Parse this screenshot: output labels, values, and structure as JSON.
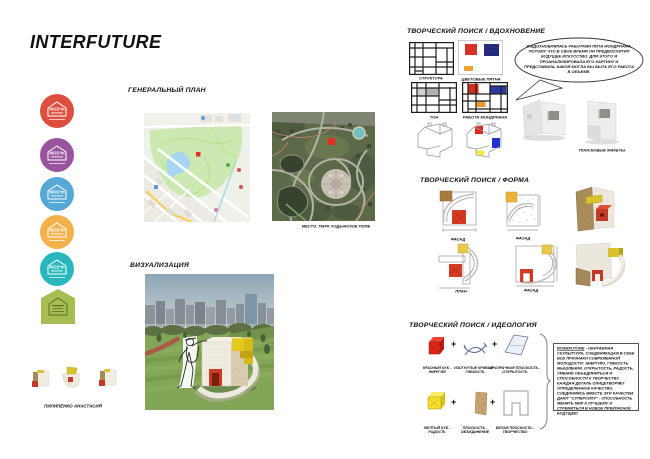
{
  "poster": {
    "title": "INTERFUTURE",
    "author": "ПИЛИПЕНКО АНАСТАСИЯ"
  },
  "badges": {
    "logo": "MOD'in",
    "colors": [
      "#dc4f3e",
      "#99549f",
      "#56a8d6",
      "#f3b14c",
      "#27b7bd",
      "#a5bd51"
    ]
  },
  "genplan": {
    "title": "ГЕНЕРАЛЬНЫЙ ПЛАН",
    "caption": "МЕСТО: ПАРК ХОДЫНСКОЕ ПОЛЕ"
  },
  "visualization": {
    "title": "ВИЗУАЛИЗАЦИЯ"
  },
  "inspiration": {
    "title": "ТВОРЧЕСКИЙ ПОИСК / ВДОХНОВЕНИЕ",
    "grid_labels": [
      "СТРУКТУРА",
      "ЦВЕТОВЫЕ ПЯТНА",
      "ТОН",
      "РАБОТА МОНДРИАНА"
    ],
    "speech_text": "Я ВДОХНОВЛЯЛАСЬ РАБОТАМИ ПИТА МОНДРИАНА, ПОТОМУ ЧТО В СВОЕ ВРЕМЯ ОН ПРЕДВОСХИТИЛ БУДУЩЕЕ ИСКУССТВО. ДЛЯ ЭТОГО Я ПРОАНАЛИЗИРОВАЛА ЕГО КАРТИНУ И ПРЕДСТАВИЛА, КАКОЙ МОГЛА БЫ БЫТЬ ЕГО РАБОТА В ОБЪЕМЕ.",
    "mockups_label": "ПОИСКОВЫЕ МАКЕТЫ"
  },
  "form": {
    "title": "ТВОРЧЕСКИЙ ПОИСК / ФОРМА",
    "drawing_labels": [
      "ФАСАД",
      "ФАСАД",
      "ПЛАН",
      "ФАСАД"
    ]
  },
  "ideology": {
    "title": "ТВОРЧЕСКИЙ ПОИСК / ИДЕОЛОГИЯ",
    "plus": "+",
    "components": [
      {
        "label": "КРАСНЫЙ КУБ -\nЭНЕРГИЯ"
      },
      {
        "label": "ИЗОГНУТЫЕ КРИВЫЕ -\nГИБКОСТЬ"
      },
      {
        "label": "ПРОЗРАЧНАЯ ПЛОСКОСТЬ -\nОТКРЫТОСТЬ"
      },
      {
        "label": "ЖЕЛТЫЙ КУБ -\nРАДОСТЬ"
      },
      {
        "label": "ПЛОСКОСТЬ -\nОБЪЕДИНЕНИЕ"
      },
      {
        "label": "БЕЛАЯ ПЛОСКОСТЬ -\nТВОРЧЕСТВО"
      }
    ],
    "statement_title": "INTERFUTURE",
    "statement_body": " - ОБИТАЕМАЯ СКУЛЬПТУРА, СОЕДИНЯЮЩАЯ В СЕБЕ ВСЕ ПРИЗНАКИ СОВРЕМЕННОЙ МОЛОДОСТИ: ЭНЕРГИЮ, ГИБКОСТЬ МЫШЛЕНИЯ, ОТКРЫТОСТЬ, РАДОСТЬ, УМЕНИЕ ОБЪЕДИНЯТЬСЯ И СПОСОБНОСТИ К ТВОРЧЕСТВУ. КАЖДАЯ ДЕТАЛЬ ОЛИЦЕТВОРЯЕТ ОПРЕДЕЛЕННОЕ КАЧЕСТВО. СОЕДИНЯЯСЬ ВМЕСТЕ ЭТИ КАЧЕСТВА ДАЮТ \"СУПЕРСИЛУ\" - СПОСОБНОСТЬ МЕНЯТЬ МИР К ЛУЧШЕМУ И СТРЕМИТЬСЯ В НОВОЕ ПРЕКРАСНОЕ БУДУЩЕЕ!"
  },
  "palette": {
    "mondrian_red": "#d63226",
    "mondrian_blue": "#232a7a",
    "mondrian_orange": "#f0a033",
    "sculpture_red": "#c93a27",
    "sculpture_yellow": "#e6c91e",
    "map_marker_red": "#e03322"
  }
}
